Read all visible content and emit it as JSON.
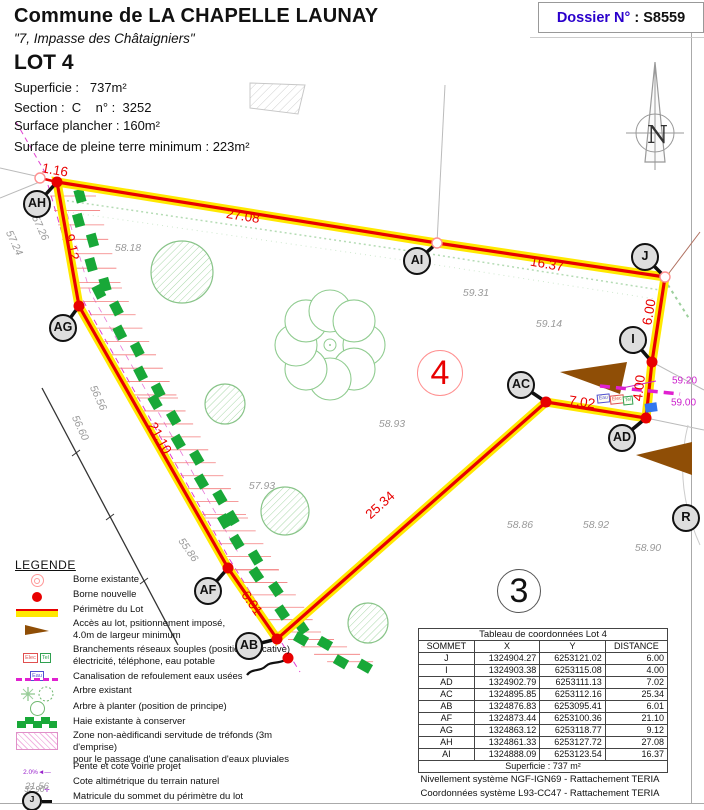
{
  "header": {
    "commune": "Commune de LA CHAPELLE LAUNAY",
    "address": "\"7, Impasse des Châtaigniers\"",
    "dossier_label": "Dossier N°",
    "dossier_value": " : S8559",
    "lot_title": "LOT 4",
    "superficie": "Superficie :   737m²",
    "section": "Section :  C    n° :  3252",
    "surface_plancher": "Surface plancher : 160m²",
    "surface_pleine_terre": "Surface de pleine terre minimum : 223m²"
  },
  "compass": {
    "north_label": "N"
  },
  "plan": {
    "lot_number": "4",
    "adjacent_lot_number": "3",
    "road_point_label": "R",
    "vertices": [
      {
        "name": "AH",
        "x": 57,
        "y": 182,
        "lx": 37,
        "ly": 204,
        "dot": "red"
      },
      {
        "name": "AG",
        "x": 79,
        "y": 306,
        "lx": 63,
        "ly": 328,
        "dot": "red"
      },
      {
        "name": "AF",
        "x": 228,
        "y": 568,
        "lx": 208,
        "ly": 591,
        "dot": "red"
      },
      {
        "name": "AB",
        "x": 277,
        "y": 639,
        "lx": 249,
        "ly": 646,
        "dot": "red"
      },
      {
        "name": "AC",
        "x": 546,
        "y": 402,
        "lx": 521,
        "ly": 385,
        "dot": "red"
      },
      {
        "name": "AD",
        "x": 646,
        "y": 418,
        "lx": 622,
        "ly": 438,
        "dot": "red"
      },
      {
        "name": "I",
        "x": 652,
        "y": 362,
        "lx": 633,
        "ly": 340,
        "dot": "red"
      },
      {
        "name": "J",
        "x": 665,
        "y": 277,
        "lx": 645,
        "ly": 257,
        "dot": "pink"
      },
      {
        "name": "AI",
        "x": 437,
        "y": 243,
        "lx": 417,
        "ly": 261,
        "dot": "pink"
      }
    ],
    "dimensions": [
      {
        "text": "1.16",
        "x": 55,
        "y": 170,
        "angle": 10
      },
      {
        "text": "27.08",
        "x": 243,
        "y": 216,
        "angle": 9
      },
      {
        "text": "16.37",
        "x": 547,
        "y": 264,
        "angle": 10
      },
      {
        "text": "6.00",
        "x": 649,
        "y": 312,
        "angle": -80
      },
      {
        "text": "4.00",
        "x": 639,
        "y": 388,
        "angle": -83
      },
      {
        "text": "7.02",
        "x": 582,
        "y": 402,
        "angle": 8
      },
      {
        "text": "25.34",
        "x": 380,
        "y": 505,
        "angle": -42
      },
      {
        "text": "6.01",
        "x": 252,
        "y": 603,
        "angle": 55
      },
      {
        "text": "21.10",
        "x": 160,
        "y": 438,
        "angle": 61
      },
      {
        "text": "9.12",
        "x": 72,
        "y": 247,
        "angle": 78
      }
    ],
    "elevations": [
      {
        "text": "57.24",
        "x": 14,
        "y": 243,
        "angle": 65
      },
      {
        "text": "57.26",
        "x": 40,
        "y": 228,
        "angle": 65
      },
      {
        "text": "58.18",
        "x": 128,
        "y": 248,
        "angle": 0
      },
      {
        "text": "59.31",
        "x": 476,
        "y": 293,
        "angle": 0
      },
      {
        "text": "59.14",
        "x": 549,
        "y": 324,
        "angle": 0
      },
      {
        "text": "58.93",
        "x": 392,
        "y": 424,
        "angle": 0
      },
      {
        "text": "56.56",
        "x": 98,
        "y": 398,
        "angle": 65
      },
      {
        "text": "56.60",
        "x": 80,
        "y": 428,
        "angle": 65
      },
      {
        "text": "55.86",
        "x": 188,
        "y": 550,
        "angle": 55
      },
      {
        "text": "57.93",
        "x": 262,
        "y": 486,
        "angle": 0
      },
      {
        "text": "58.86",
        "x": 520,
        "y": 525,
        "angle": 0
      },
      {
        "text": "58.92",
        "x": 596,
        "y": 525,
        "angle": 0
      },
      {
        "text": "58.90",
        "x": 648,
        "y": 548,
        "angle": 0
      }
    ],
    "utility_labels": [
      {
        "text": "59.20",
        "x": 672,
        "y": 381
      },
      {
        "text": "59.00",
        "x": 671,
        "y": 403
      }
    ],
    "utility_boxes": [
      "Eau",
      "Elec",
      "Tel"
    ]
  },
  "legend": {
    "title": "LEGENDE",
    "items": [
      {
        "lines": [
          "Borne existante"
        ]
      },
      {
        "lines": [
          "Borne nouvelle"
        ]
      },
      {
        "lines": [
          "Périmètre du Lot"
        ]
      },
      {
        "lines": [
          "Accès au lot, psitionnement imposé,",
          "4.0m de largeur minimum"
        ]
      },
      {
        "lines": [
          "Branchements réseaux souples (position indicative)",
          "électricité, téléphone, eau potable"
        ]
      },
      {
        "lines": [
          "Canalisation de refoulement eaux usées"
        ]
      },
      {
        "lines": [
          "Arbre existant"
        ]
      },
      {
        "lines": [
          "Arbre à planter (position de principe)"
        ]
      },
      {
        "lines": [
          "Haie existante à conserver"
        ]
      },
      {
        "lines": [
          "Zone non-aèdificandi servitude de tréfonds (3m d'emprise)",
          "pour le passage d'une canalisation d'eaux pluviales"
        ]
      },
      {
        "lines": [
          "Pente et cote voirie projet"
        ]
      },
      {
        "lines": [
          "Cote altimétrique du terrain naturel"
        ]
      },
      {
        "lines": [
          "Matricule du sommet du périmètre du lot"
        ]
      }
    ],
    "branchement_boxes": [
      "Elec",
      "Tel",
      "Eau"
    ],
    "pente_values": {
      "percent": "2.0%",
      "cote": "32.90"
    },
    "cote_example": "21.56",
    "matricule_example": "J"
  },
  "table": {
    "title": "Tableau de coordonnées Lot 4",
    "headers": [
      "SOMMET",
      "X",
      "Y",
      "DISTANCE"
    ],
    "rows": [
      [
        "J",
        "1324904.27",
        "6253121.02",
        "6.00"
      ],
      [
        "I",
        "1324903.38",
        "6253115.08",
        "4.00"
      ],
      [
        "AD",
        "1324902.79",
        "6253111.13",
        "7.02"
      ],
      [
        "AC",
        "1324895.85",
        "6253112.16",
        "25.34"
      ],
      [
        "AB",
        "1324876.83",
        "6253095.41",
        "6.01"
      ],
      [
        "AF",
        "1324873.44",
        "6253100.36",
        "21.10"
      ],
      [
        "AG",
        "1324863.12",
        "6253118.77",
        "9.12"
      ],
      [
        "AH",
        "1324861.33",
        "6253127.72",
        "27.08"
      ],
      [
        "AI",
        "1324888.09",
        "6253123.54",
        "16.37"
      ]
    ],
    "footer": "Superficie : 737 m²"
  },
  "footnotes": [
    "Nivellement système NGF-IGN69 - Rattachement TERIA",
    "Coordonnées système L93-CC47  - Rattachement TERIA"
  ],
  "colors": {
    "boundary_red": "#e80000",
    "boundary_yellow": "#ffe800",
    "hedge_green": "#18a838",
    "tree_green": "#88c488",
    "magenta": "#e020d0",
    "access_brown": "#8f4e06",
    "elevation_gray": "#9a9a9a",
    "dossier_blue": "#2a00cc"
  }
}
